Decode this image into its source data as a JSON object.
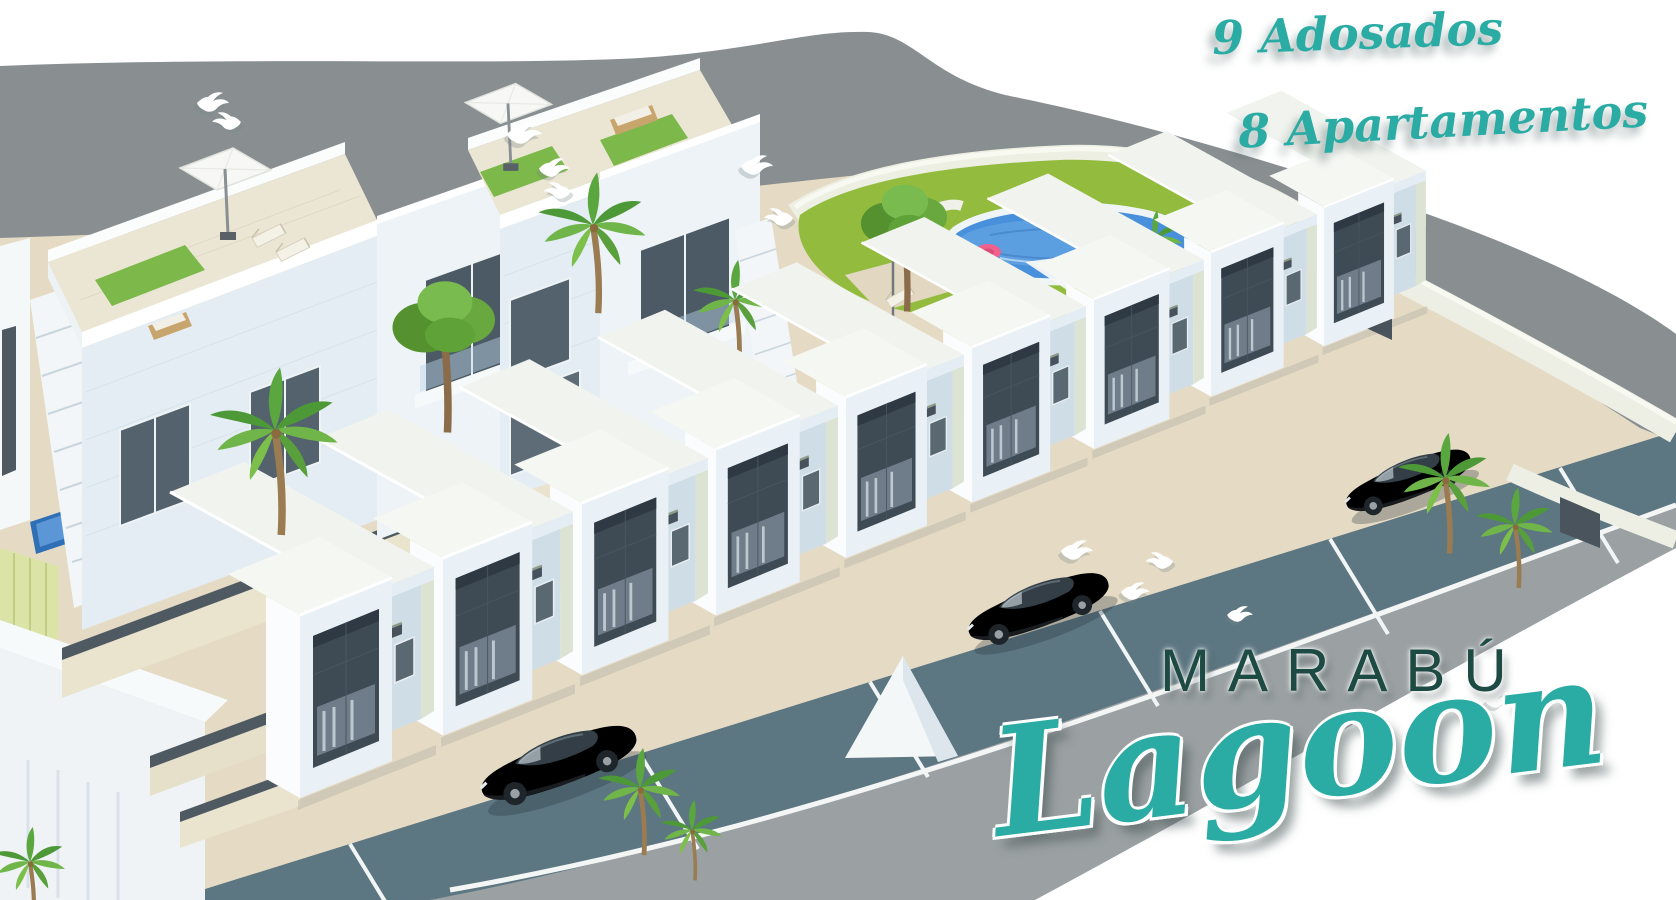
{
  "meta": {
    "image_type": "3D architectural rendering (aerial view of residential development)",
    "development_name": "Marabú Lagoon"
  },
  "overlay": {
    "adosados_label": "9 Adosados",
    "apartamentos_label": "8 Apartamentos",
    "brand_title": "MARABÚ",
    "brand_script": "Lagoon"
  },
  "scene": {
    "townhouse_count": 9,
    "apartment_building_count": 2,
    "parked_car_count": 3,
    "dove_count": 12,
    "palm_tree_count": 8,
    "pool_count": 2,
    "umbrella_count": 3
  },
  "colors": {
    "brand_teal": "#2AABA4",
    "brand_dark_green": "#1D4B44",
    "street_gray": "#898F91",
    "road_gray": "#9BA1A3",
    "parking_lane": "#5C7682",
    "pool_water": "#4890DC",
    "lawn_green": "#93BC3F",
    "sand_beige": "#E5DBC5",
    "facade_white": "#E9F0F6",
    "window_charcoal": "#3E4A54",
    "door_brown": "#A9773C"
  }
}
